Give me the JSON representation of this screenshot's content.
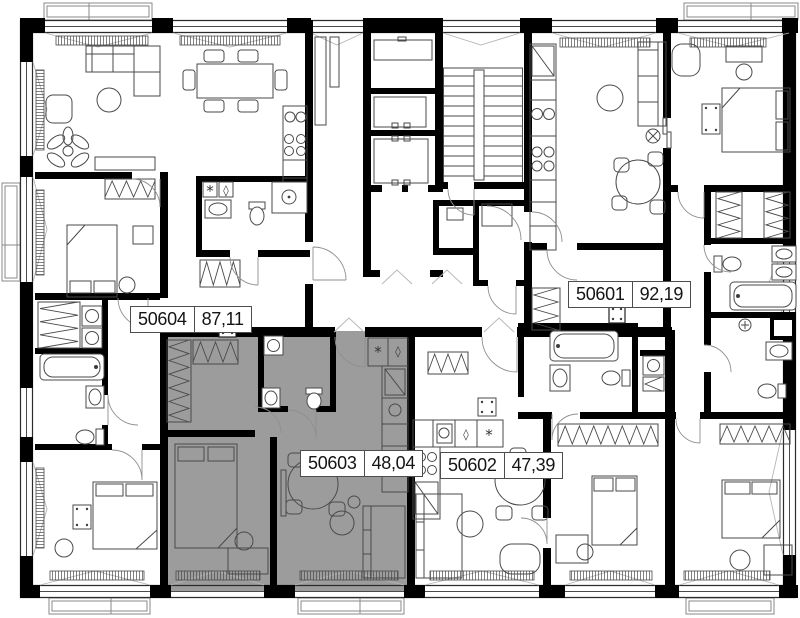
{
  "plan": {
    "title": "apartment-floor-plan",
    "units": [
      {
        "number": "50604",
        "area": "87,11",
        "highlighted": false
      },
      {
        "number": "50601",
        "area": "92,19",
        "highlighted": false
      },
      {
        "number": "50603",
        "area": "48,04",
        "highlighted": true
      },
      {
        "number": "50602",
        "area": "47,39",
        "highlighted": false
      }
    ],
    "symbols": {
      "washer": "*",
      "diamond": "◊"
    },
    "colors": {
      "wall": "#000000",
      "furniture_line": "#4a4a4a",
      "highlight_fill": "#9c9c9c",
      "background": "#ffffff",
      "label_border": "#4d4d4d",
      "label_text": "#141414"
    }
  }
}
